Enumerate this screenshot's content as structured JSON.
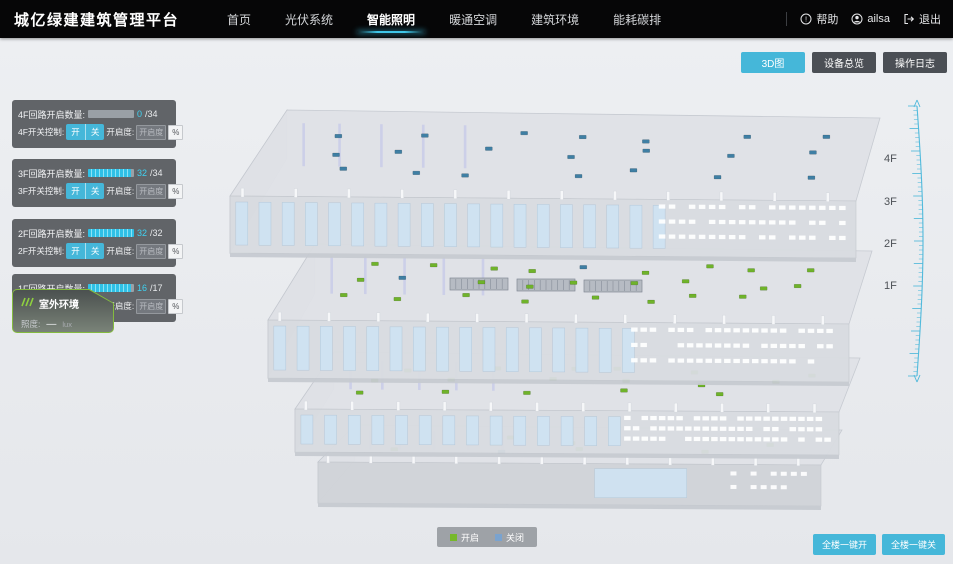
{
  "header": {
    "title": "城亿绿建建筑管理平台",
    "nav": [
      {
        "label": "首页",
        "active": false
      },
      {
        "label": "光伏系统",
        "active": false
      },
      {
        "label": "智能照明",
        "active": true
      },
      {
        "label": "暖通空调",
        "active": false
      },
      {
        "label": "建筑环境",
        "active": false
      },
      {
        "label": "能耗碳排",
        "active": false
      }
    ],
    "help_label": "帮助",
    "username": "ailsa",
    "logout_label": "退出"
  },
  "view_buttons": [
    {
      "label": "3D图",
      "active": true
    },
    {
      "label": "设备总览",
      "active": false
    },
    {
      "label": "操作日志",
      "active": false
    }
  ],
  "floor_panels": [
    {
      "floor": "4F",
      "circuit_label": "4F回路开启数量:",
      "on_count": "0",
      "total_display": "/34",
      "progress_pct": 0,
      "switch_label": "4F开关控制:",
      "on_btn": "开",
      "off_btn": "关",
      "dim_label": "开启度:",
      "dim_placeholder": "开启度",
      "percent_label": "%"
    },
    {
      "floor": "3F",
      "circuit_label": "3F回路开启数量:",
      "on_count": "32",
      "total_display": "/34",
      "progress_pct": 94,
      "switch_label": "3F开关控制:",
      "on_btn": "开",
      "off_btn": "关",
      "dim_label": "开启度:",
      "dim_placeholder": "开启度",
      "percent_label": "%"
    },
    {
      "floor": "2F",
      "circuit_label": "2F回路开启数量:",
      "on_count": "32",
      "total_display": "/32",
      "progress_pct": 100,
      "switch_label": "2F开关控制:",
      "on_btn": "开",
      "off_btn": "关",
      "dim_label": "开启度:",
      "dim_placeholder": "开启度",
      "percent_label": "%"
    },
    {
      "floor": "1F",
      "circuit_label": "1F回路开启数量:",
      "on_count": "16",
      "total_display": "/17",
      "progress_pct": 94,
      "switch_label": "1F开关控制:",
      "on_btn": "开",
      "off_btn": "关",
      "dim_label": "开启度:",
      "dim_placeholder": "开启度",
      "percent_label": "%"
    }
  ],
  "outdoor": {
    "title": "室外环境",
    "illuminance_label": "照度:",
    "illuminance_value": "—",
    "illuminance_unit": "lux"
  },
  "floor_axis": [
    "4F",
    "3F",
    "2F",
    "1F"
  ],
  "legend": [
    {
      "label": "开启",
      "color": "#76b82a"
    },
    {
      "label": "关闭",
      "color": "#7aa3cf"
    }
  ],
  "bottom_buttons": [
    {
      "label": "全楼一键开"
    },
    {
      "label": "全楼一键关"
    }
  ],
  "building": {
    "light_on_color": "#6fb32a",
    "light_off_color": "#3f7fa4",
    "floors": [
      {
        "name": "4F",
        "circuits_total": 34,
        "circuits_on": 0,
        "visible_lights": 21
      },
      {
        "name": "3F",
        "circuits_total": 34,
        "circuits_on": 32,
        "visible_lights": 26
      },
      {
        "name": "2F",
        "circuits_total": 32,
        "circuits_on": 32,
        "visible_lights": 17
      },
      {
        "name": "1F",
        "circuits_total": 17,
        "circuits_on": 16,
        "visible_lights": 9
      }
    ]
  },
  "colors": {
    "accent": "#45b7d9",
    "ruler": "#4ab7da",
    "panel_bg": "#56595e",
    "header_bg": "#060607",
    "bg": "#e8eaed"
  }
}
